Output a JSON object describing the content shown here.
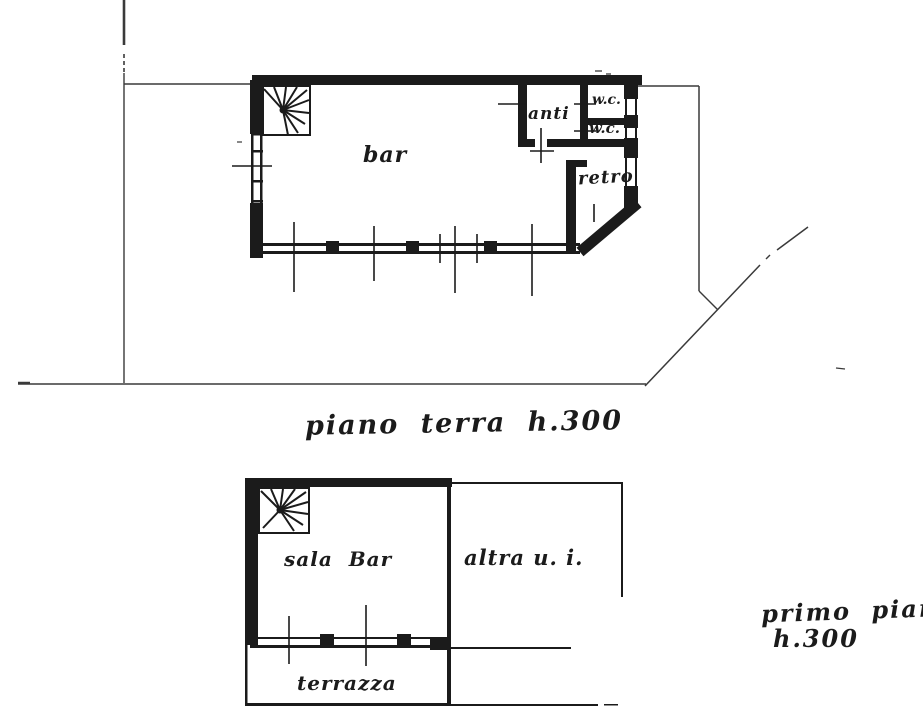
{
  "colors": {
    "ink": "#1b1b1b",
    "paper": "#ffffff"
  },
  "plans": {
    "ground": {
      "caption": "piano terra h.300",
      "labels": {
        "bar": "bar",
        "anti": "anti",
        "wc_top": "w.c.",
        "wc_bottom": "w.c.",
        "retro": "retro"
      }
    },
    "first": {
      "caption_line1": "primo piano",
      "caption_line2": "h.300",
      "labels": {
        "sala_bar": "sala Bar",
        "altra_ui": "altra u. i.",
        "terrazza": "terrazza"
      }
    }
  },
  "icons": {
    "staircase_ground": "spiral-staircase",
    "staircase_first": "spiral-staircase"
  }
}
